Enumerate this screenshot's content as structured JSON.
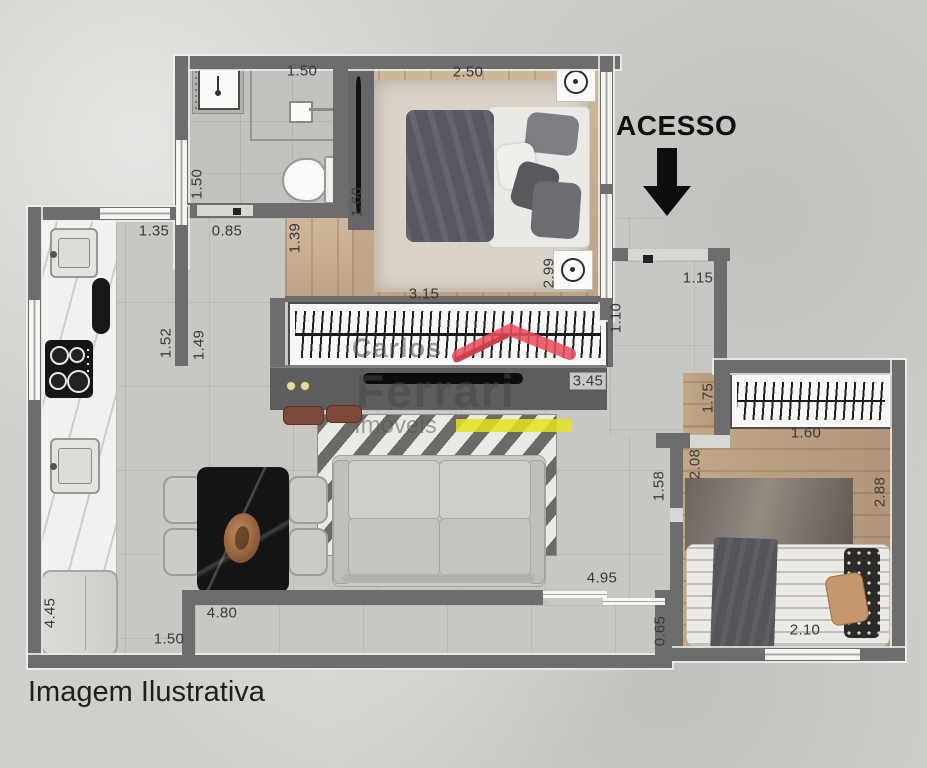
{
  "page": {
    "access_label": "ACESSO",
    "caption": "Imagem Ilustrativa"
  },
  "watermark": {
    "line1": "Carlos",
    "line2": "Ferrari",
    "line3": "Imóveis",
    "red": "#e94f5e",
    "yellow": "#e3e41f",
    "text_color": "rgba(70,70,70,0.52)"
  },
  "colors": {
    "wall": "#6d6d6d",
    "canvas_background": "#d0cfcb",
    "floor_tile": "#c8c7c3",
    "wood_bedroom1": "#c7ad90",
    "wood_bedroom2": "#b89e81",
    "arrow": "#0d0d0d"
  },
  "measurements": {
    "horizontal": [
      {
        "text": "1.50",
        "x": 302,
        "y": 71
      },
      {
        "text": "2.50",
        "x": 468,
        "y": 72
      },
      {
        "text": "1.35",
        "x": 154,
        "y": 231
      },
      {
        "text": "0.85",
        "x": 227,
        "y": 231
      },
      {
        "text": "3.15",
        "x": 424,
        "y": 294
      },
      {
        "text": "1.15",
        "x": 698,
        "y": 278
      },
      {
        "text": "3.45",
        "x": 588,
        "y": 381,
        "chip": true
      },
      {
        "text": "1.60",
        "x": 806,
        "y": 433
      },
      {
        "text": "4.95",
        "x": 602,
        "y": 578
      },
      {
        "text": "4.80",
        "x": 222,
        "y": 613
      },
      {
        "text": "1.50",
        "x": 169,
        "y": 639
      },
      {
        "text": "2.10",
        "x": 805,
        "y": 630
      }
    ],
    "vertical": [
      {
        "text": "1.50",
        "x": 197,
        "y": 184
      },
      {
        "text": "1.52",
        "x": 166,
        "y": 343
      },
      {
        "text": "1.49",
        "x": 199,
        "y": 345
      },
      {
        "text": "1.39",
        "x": 295,
        "y": 238
      },
      {
        "text": "1.60",
        "x": 357,
        "y": 202
      },
      {
        "text": "2.99",
        "x": 549,
        "y": 273
      },
      {
        "text": "1.10",
        "x": 616,
        "y": 318
      },
      {
        "text": "1.75",
        "x": 708,
        "y": 398
      },
      {
        "text": "2.08",
        "x": 695,
        "y": 464
      },
      {
        "text": "1.58",
        "x": 659,
        "y": 486
      },
      {
        "text": "2.88",
        "x": 880,
        "y": 492
      },
      {
        "text": "0.65",
        "x": 660,
        "y": 631
      },
      {
        "text": "4.45",
        "x": 50,
        "y": 613
      }
    ]
  }
}
